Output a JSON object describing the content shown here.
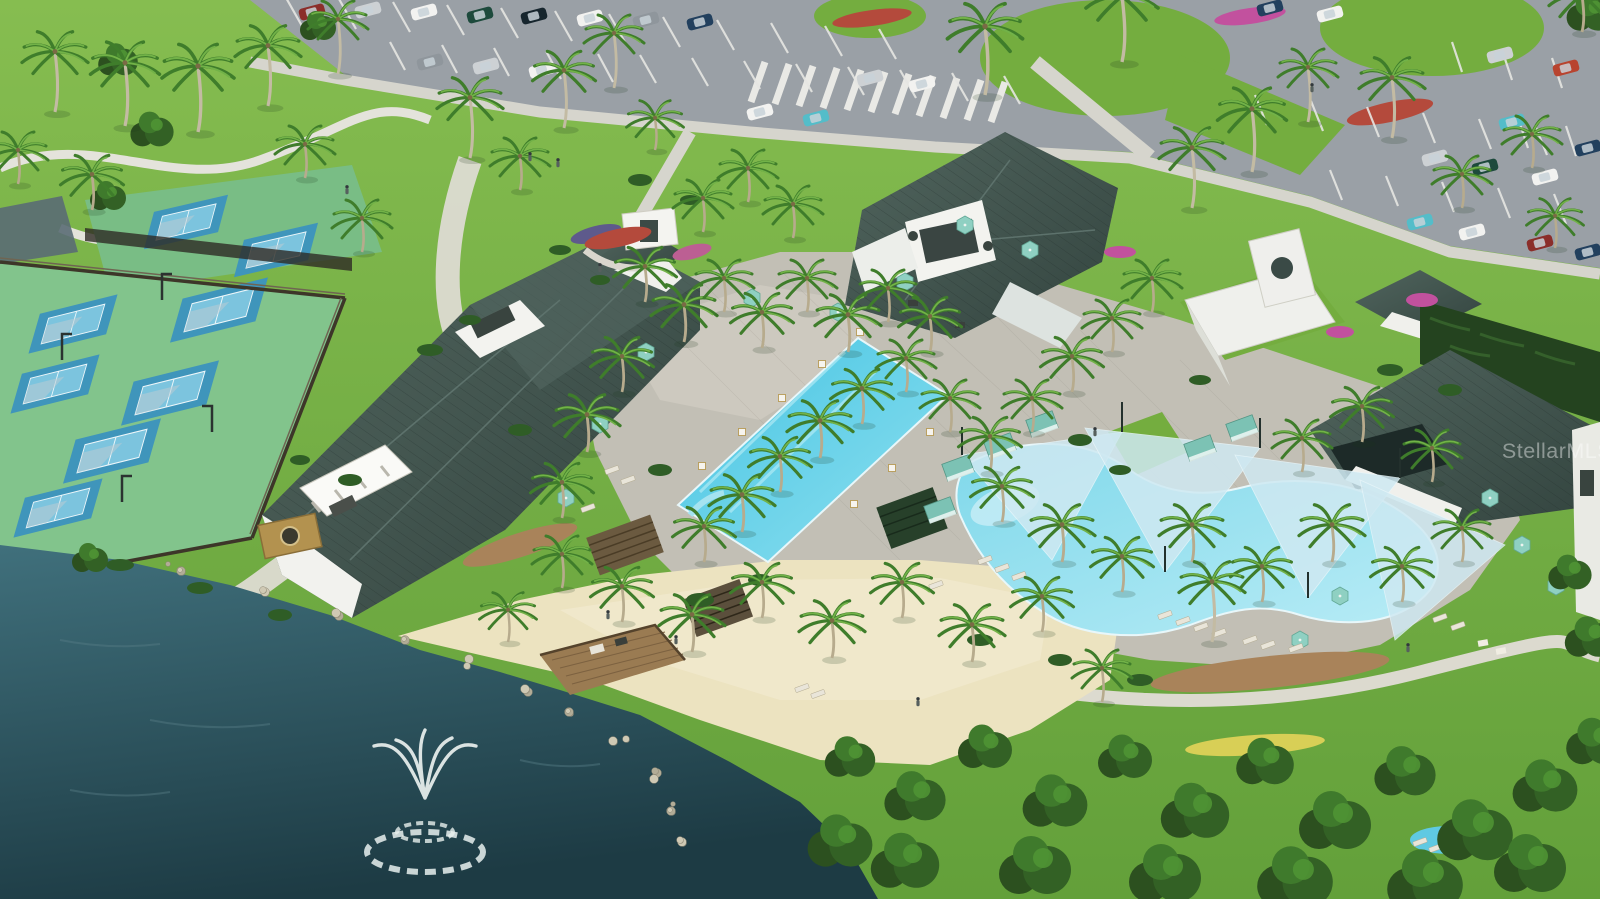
{
  "meta": {
    "type": "aerial-3d-architectural-rendering",
    "width_px": 1600,
    "height_px": 899
  },
  "watermark": {
    "text": "StellarMLS",
    "color": "rgba(255,255,255,0.42)"
  },
  "scene": {
    "description": "Aerial rendering of a resort-style community amenity campus",
    "amenities": [
      "parking lot with cars",
      "pickleball courts",
      "event lawn with curved paths",
      "clubhouse with standing-seam metal roofs",
      "poolside bar pavilion with cupola",
      "rectangular lap pool with columns",
      "lagoon pool with shade sails",
      "teal cabanas and umbrellas",
      "tiki bar pavilion",
      "sandy beach with palms",
      "lake with aerator fountain",
      "wooden dock",
      "gold monument sign",
      "hedge wall with bougainvillea"
    ],
    "counts": {
      "pickleball_courts": 8,
      "shade_sails": 4,
      "cabanas": 6,
      "fountains": 1,
      "docks": 1
    }
  },
  "palette": {
    "grass": "#79b344",
    "grass_dark": "#5d9336",
    "lake_top": "#40707c",
    "lake_bottom": "#1d3b44",
    "pool": "#52cbe6",
    "lagoon": "#8edfee",
    "shade_sail": "#cfe9f2",
    "sand": "#ece3c0",
    "asphalt": "#9aa0a6",
    "roof": "#42554f",
    "walls": "#f2f2ee",
    "path": "#dddbd2",
    "deck": "#c2bfb5",
    "umbrella_teal": "#8fd0c2",
    "hedge": "#24431f",
    "court_blue": "#3f95bb",
    "court_inner": "#7cc4de",
    "court_apron": "#82c48c",
    "flower_red": "#b44a3c",
    "bougainvillea": "#c2519e",
    "sign_gold": "#b3924f",
    "car_colors": [
      "#f2f2f0",
      "#cdd1d4",
      "#8b2e2a",
      "#1d4a3c",
      "#22405e",
      "#54bdc9",
      "#8f969c",
      "#17262e",
      "#b8442f"
    ]
  }
}
